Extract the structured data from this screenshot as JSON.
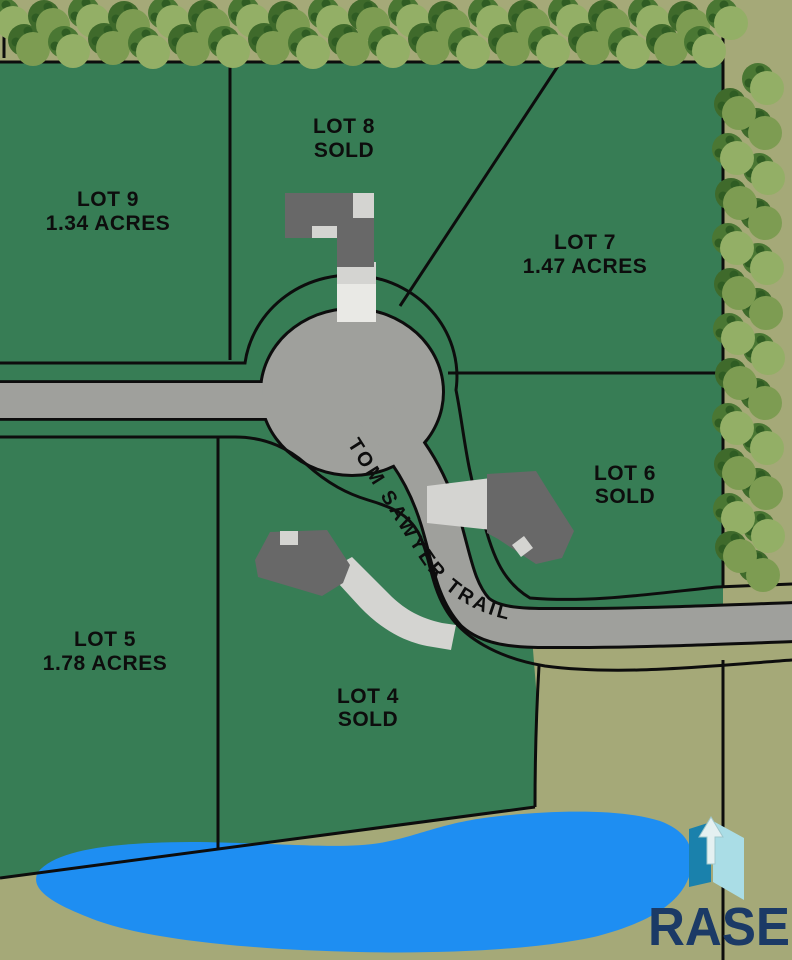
{
  "map": {
    "type": "subdivision plat map",
    "road": {
      "name": "TOM SAWYER TRAIL"
    },
    "lots": [
      {
        "id": "lot-9",
        "name": "LOT 9",
        "detail": "1.34 ACRES"
      },
      {
        "id": "lot-8",
        "name": "LOT 8",
        "detail": "SOLD"
      },
      {
        "id": "lot-7",
        "name": "LOT 7",
        "detail": "1.47 ACRES"
      },
      {
        "id": "lot-6",
        "name": "LOT 6",
        "detail": "SOLD"
      },
      {
        "id": "lot-5",
        "name": "LOT 5",
        "detail": "1.78 ACRES"
      },
      {
        "id": "lot-4",
        "name": "LOT 4",
        "detail": "SOLD"
      }
    ],
    "branding": {
      "logo_text": "RASE"
    },
    "palette": {
      "background_olive": "#a5a978",
      "parcel_green": "#377d55",
      "boundary_black": "#0d0d0d",
      "road_gray": "#9fa09c",
      "driveway_light_gray": "#d4d4d1",
      "driveway_pale": "#e9e9e5",
      "house_dark_gray": "#686868",
      "pond_blue": "#1e8ef2",
      "tree_light_a": "#93af66",
      "tree_light_b": "#7d9c52",
      "tree_shade_a": "#4a7733",
      "tree_shade_b": "#3f6a2b",
      "tree_tuft_dark": "#2f5c23",
      "logo_navy": "#1b3a66",
      "logo_teal": "#1a81ac",
      "logo_sky": "#aadde6",
      "logo_arrow": "#e4f0f1"
    }
  }
}
